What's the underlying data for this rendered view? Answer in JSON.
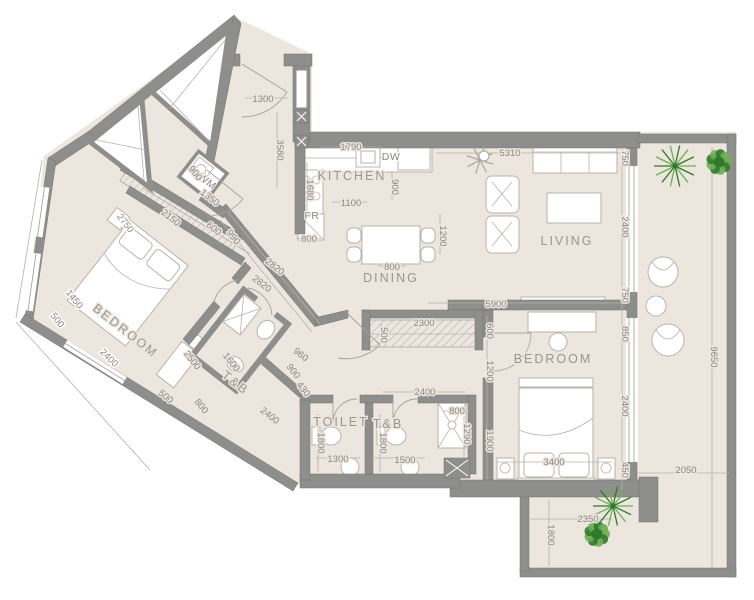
{
  "title": "Apartment Unit Floor Plan",
  "colors": {
    "wall": "#8e8e8c",
    "floor": "#ece6df",
    "dim_text": "#8b8680",
    "room_text": "#9a958d",
    "furniture_stroke": "#b8b3ab",
    "plant_dark": "#2f7a2a",
    "plant_light": "#6fae53",
    "decor_gray": "#a9a49c"
  },
  "rooms": [
    {
      "text": "KITCHEN",
      "x": 352,
      "y": 180,
      "r": 0
    },
    {
      "text": "DINING",
      "x": 391,
      "y": 282,
      "r": 0
    },
    {
      "text": "LIVING",
      "x": 567,
      "y": 245,
      "r": 0
    },
    {
      "text": "BEDROOM",
      "x": 123,
      "y": 334,
      "r": 38
    },
    {
      "text": "BEDROOM",
      "x": 553,
      "y": 363,
      "r": 0
    },
    {
      "text": "TOILET",
      "x": 341,
      "y": 426,
      "r": 0
    },
    {
      "text": "T&B",
      "x": 388,
      "y": 428,
      "r": 0
    },
    {
      "text": "T&B",
      "x": 233,
      "y": 386,
      "r": 38
    }
  ],
  "fixtures": [
    {
      "text": "FR",
      "x": 312,
      "y": 219,
      "r": 0
    },
    {
      "text": "DW",
      "x": 391,
      "y": 160,
      "r": 0
    },
    {
      "text": "WM",
      "x": 205,
      "y": 184,
      "r": 38
    }
  ],
  "dimensions": [
    {
      "text": "1300",
      "x": 263,
      "y": 102,
      "r": 0
    },
    {
      "text": "3580",
      "x": 277,
      "y": 150,
      "r": 90
    },
    {
      "text": "1790",
      "x": 351,
      "y": 150,
      "r": 0
    },
    {
      "text": "5310",
      "x": 510,
      "y": 156,
      "r": 0
    },
    {
      "text": "750",
      "x": 622,
      "y": 158,
      "r": 90
    },
    {
      "text": "2400",
      "x": 622,
      "y": 227,
      "r": 90
    },
    {
      "text": "750",
      "x": 622,
      "y": 295,
      "r": 90
    },
    {
      "text": "900",
      "x": 392,
      "y": 187,
      "r": 90
    },
    {
      "text": "1680",
      "x": 307,
      "y": 190,
      "r": 90
    },
    {
      "text": "1100",
      "x": 351,
      "y": 206,
      "r": 0
    },
    {
      "text": "800",
      "x": 309,
      "y": 242,
      "r": 0
    },
    {
      "text": "800",
      "x": 392,
      "y": 270,
      "r": 0
    },
    {
      "text": "1200",
      "x": 440,
      "y": 236,
      "r": 90
    },
    {
      "text": "5900",
      "x": 496,
      "y": 307,
      "r": 0
    },
    {
      "text": "2300",
      "x": 424,
      "y": 326,
      "r": 0
    },
    {
      "text": "500",
      "x": 381,
      "y": 335,
      "r": 90
    },
    {
      "text": "600",
      "x": 487,
      "y": 331,
      "r": 90
    },
    {
      "text": "1200",
      "x": 487,
      "y": 371,
      "r": 90
    },
    {
      "text": "1900",
      "x": 487,
      "y": 441,
      "r": 90
    },
    {
      "text": "850",
      "x": 622,
      "y": 334,
      "r": 90
    },
    {
      "text": "2400",
      "x": 622,
      "y": 406,
      "r": 90
    },
    {
      "text": "450",
      "x": 622,
      "y": 470,
      "r": 90
    },
    {
      "text": "3400",
      "x": 554,
      "y": 465,
      "r": 0
    },
    {
      "text": "2050",
      "x": 686,
      "y": 473,
      "r": 0
    },
    {
      "text": "9650",
      "x": 711,
      "y": 357,
      "r": 90
    },
    {
      "text": "2350",
      "x": 588,
      "y": 522,
      "r": 0
    },
    {
      "text": "1800",
      "x": 548,
      "y": 535,
      "r": 90
    },
    {
      "text": "2400",
      "x": 425,
      "y": 395,
      "r": 0
    },
    {
      "text": "800",
      "x": 457,
      "y": 414,
      "r": 0
    },
    {
      "text": "1290",
      "x": 464,
      "y": 434,
      "r": 90
    },
    {
      "text": "1800",
      "x": 318,
      "y": 443,
      "r": 90
    },
    {
      "text": "1300",
      "x": 338,
      "y": 462,
      "r": 0
    },
    {
      "text": "1800",
      "x": 380,
      "y": 443,
      "r": 90
    },
    {
      "text": "1500",
      "x": 405,
      "y": 463,
      "r": 0
    },
    {
      "text": "900",
      "x": 193,
      "y": 175,
      "r": 52
    },
    {
      "text": "1350",
      "x": 208,
      "y": 200,
      "r": 38
    },
    {
      "text": "2150",
      "x": 169,
      "y": 220,
      "r": 38
    },
    {
      "text": "600",
      "x": 212,
      "y": 231,
      "r": 38
    },
    {
      "text": "990",
      "x": 231,
      "y": 239,
      "r": 52
    },
    {
      "text": "2820",
      "x": 273,
      "y": 269,
      "r": 38
    },
    {
      "text": "2820",
      "x": 260,
      "y": 286,
      "r": 38
    },
    {
      "text": "2750",
      "x": 123,
      "y": 225,
      "r": 52,
      "out": true
    },
    {
      "text": "1450",
      "x": 72,
      "y": 301,
      "r": 52,
      "out": true
    },
    {
      "text": "500",
      "x": 55,
      "y": 322,
      "r": 52,
      "out": true
    },
    {
      "text": "2400",
      "x": 107,
      "y": 360,
      "r": 45,
      "out": true
    },
    {
      "text": "500",
      "x": 164,
      "y": 399,
      "r": 38
    },
    {
      "text": "800",
      "x": 199,
      "y": 408,
      "r": 52
    },
    {
      "text": "2400",
      "x": 268,
      "y": 418,
      "r": 38
    },
    {
      "text": "2500",
      "x": 190,
      "y": 362,
      "r": 52
    },
    {
      "text": "1600",
      "x": 229,
      "y": 364,
      "r": 52
    },
    {
      "text": "960",
      "x": 299,
      "y": 357,
      "r": 38
    },
    {
      "text": "900",
      "x": 291,
      "y": 373,
      "r": 52
    },
    {
      "text": "430",
      "x": 301,
      "y": 391,
      "r": 52
    }
  ],
  "dim_lines": [
    [
      245,
      98,
      288,
      98
    ],
    [
      277,
      112,
      277,
      188
    ],
    [
      320,
      147,
      382,
      147
    ],
    [
      436,
      153,
      622,
      153
    ],
    [
      428,
      303,
      622,
      303
    ],
    [
      622,
      148,
      622,
      490
    ],
    [
      487,
      316,
      487,
      480
    ],
    [
      712,
      147,
      712,
      568
    ],
    [
      637,
      473,
      729,
      473
    ],
    [
      530,
      519,
      612,
      519
    ],
    [
      549,
      500,
      549,
      566
    ],
    [
      498,
      462,
      612,
      462
    ],
    [
      383,
      392,
      465,
      392
    ],
    [
      443,
      411,
      470,
      411
    ],
    [
      464,
      416,
      464,
      458
    ],
    [
      318,
      414,
      318,
      472
    ],
    [
      380,
      414,
      380,
      472
    ],
    [
      316,
      458,
      360,
      458
    ],
    [
      372,
      458,
      425,
      458
    ],
    [
      332,
      202,
      367,
      202
    ],
    [
      296,
      238,
      322,
      238
    ],
    [
      378,
      266,
      406,
      266
    ],
    [
      440,
      214,
      440,
      254
    ],
    [
      392,
      172,
      392,
      200
    ],
    [
      307,
      162,
      307,
      214
    ],
    [
      381,
      323,
      381,
      344
    ],
    [
      228,
      212,
      320,
      324
    ],
    [
      220,
      220,
      312,
      332
    ],
    [
      143,
      188,
      250,
      254
    ],
    [
      42,
      160,
      16,
      318
    ],
    [
      16,
      322,
      150,
      470
    ]
  ],
  "plants": [
    {
      "type": "palm",
      "x": 675,
      "y": 166,
      "r": 21
    },
    {
      "type": "bush",
      "x": 719,
      "y": 162,
      "r": 13
    },
    {
      "type": "palm",
      "x": 613,
      "y": 506,
      "r": 20
    },
    {
      "type": "bush",
      "x": 597,
      "y": 534,
      "r": 13
    },
    {
      "type": "star",
      "x": 480,
      "y": 160,
      "r": 14
    }
  ]
}
